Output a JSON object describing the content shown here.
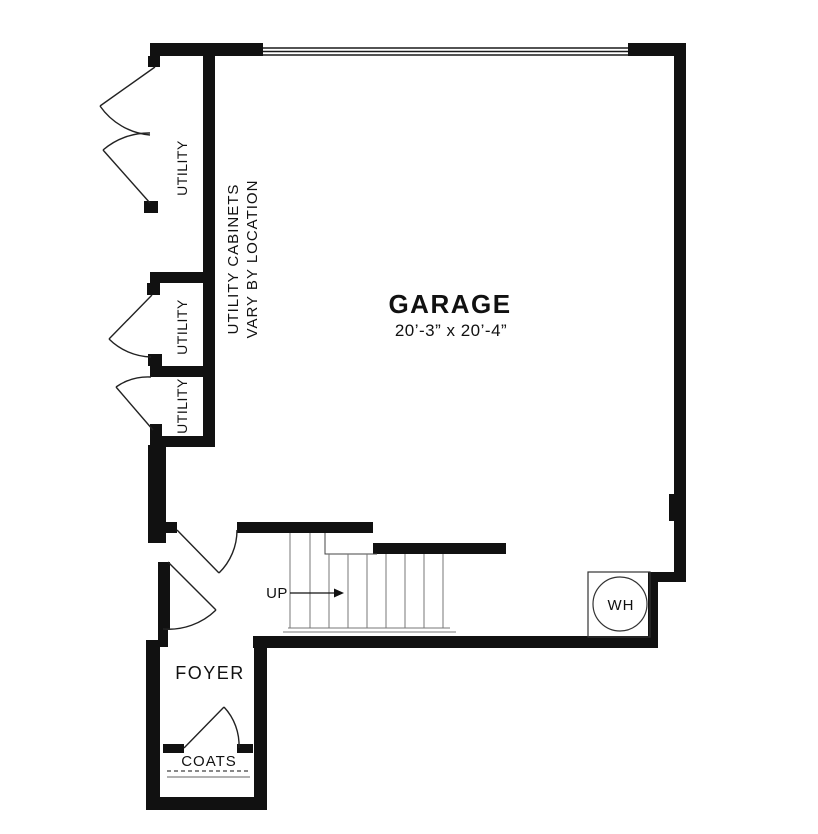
{
  "floor_plan": {
    "garage": {
      "name": "GARAGE",
      "dimensions": "20’-3” x 20’-4”"
    },
    "foyer": {
      "name": "FOYER"
    },
    "coats_closet": {
      "name": "COATS"
    },
    "utility_closets": [
      {
        "name": "UTILITY"
      },
      {
        "name": "UTILITY"
      },
      {
        "name": "UTILITY"
      }
    ],
    "utility_note": {
      "line1": "UTILITY CABINETS",
      "line2": "VARY BY LOCATION"
    },
    "stairs": {
      "direction_label": "UP"
    },
    "water_heater": {
      "label": "WH"
    },
    "colors": {
      "walls": "#111111",
      "door_lines": "#222222",
      "stair_treads": "#777777",
      "background": "#ffffff"
    }
  }
}
